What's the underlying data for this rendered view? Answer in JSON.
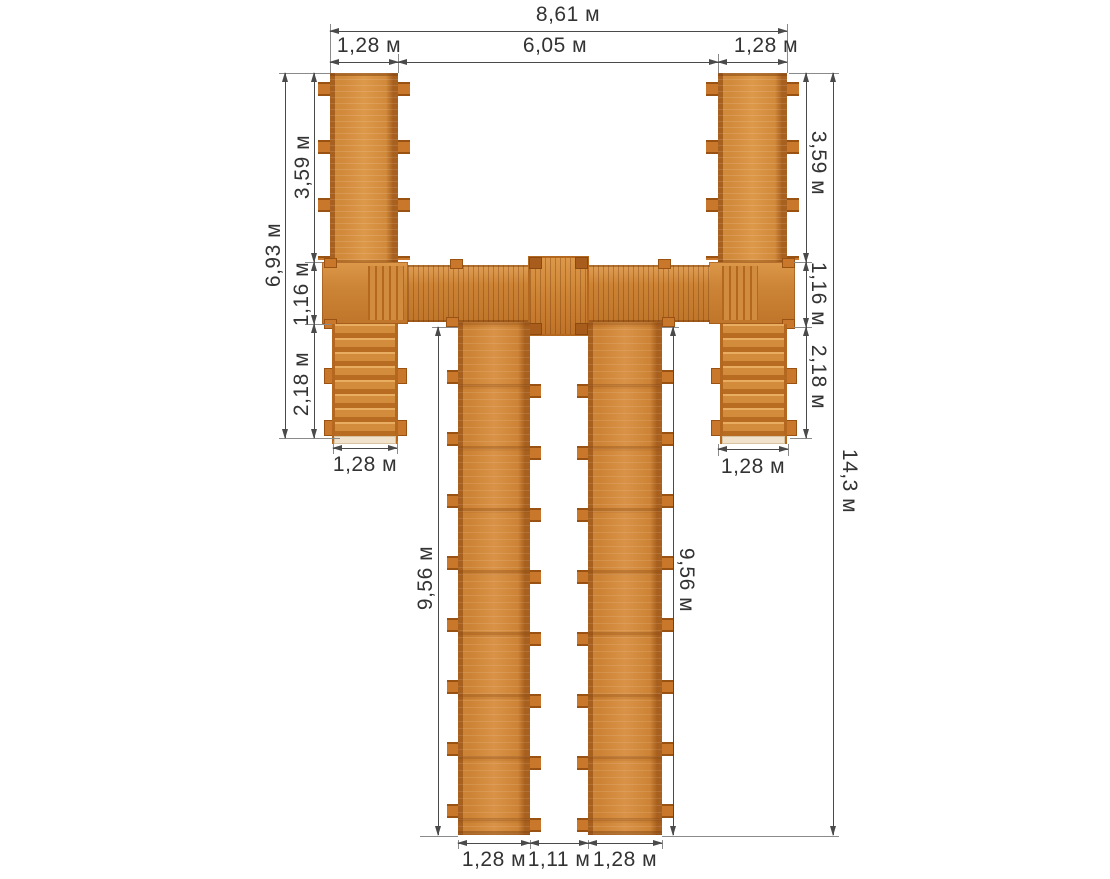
{
  "diagram": {
    "type": "plan-view dimensioned drawing of wooden walkway structure",
    "units": "м",
    "dimensions": {
      "top": {
        "total_width": "8,61 м",
        "left_ramp_width": "1,28 м",
        "inner_span": "6,05 м",
        "right_ramp_width": "1,28 м"
      },
      "left": {
        "overall_height": "6,93 м",
        "ramp_length": "3,59 м",
        "platform_depth": "1,16 м",
        "stair_length": "2,18 м",
        "stair_width": "1,28 м"
      },
      "right": {
        "ramp_length": "3,59 м",
        "platform_depth": "1,16 м",
        "stair_length": "2,18 м",
        "stair_width": "1,28 м",
        "overall_height": "14,3 м"
      },
      "walkways": {
        "left_length": "9,56 м",
        "right_length": "9,56 м"
      },
      "bottom": {
        "left_walkway_width": "1,28 м",
        "gap": "1,11 м",
        "right_walkway_width": "1,28 м"
      }
    },
    "colors": {
      "wood_main": "#d08a3c",
      "wood_light": "#dd9849",
      "wood_rail": "#a8601f",
      "wood_dark": "#9a5212",
      "step_light": "#f1e3cb",
      "dim_line": "#4a4a4a",
      "ext_line": "#8a8a8a",
      "text": "#333333",
      "background": "#ffffff"
    }
  }
}
